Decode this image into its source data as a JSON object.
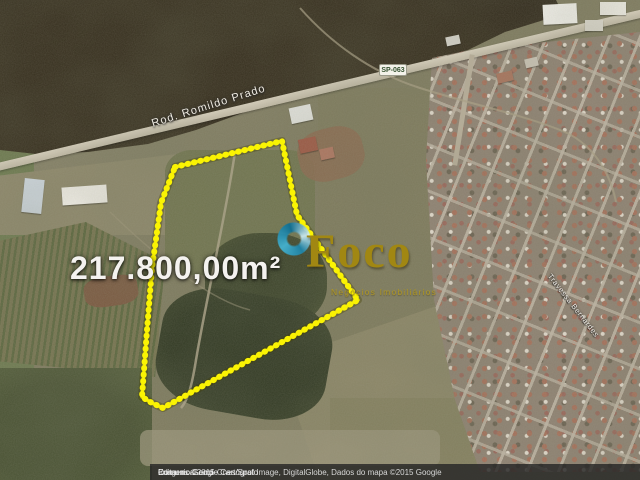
{
  "map": {
    "area_label": "217.800,00m²",
    "road_label": "Rod. Romildo Prado",
    "road_shield": "SP-063",
    "street_label": "Travessa Bernardes",
    "parcel_outline": {
      "color": "#faf303",
      "points": "175,167 282,141 297,215 358,300 163,408 152,403 142,397 147,330 152,268 161,203"
    }
  },
  "logo": {
    "text": "Foco",
    "tagline": "Negócios Imobiliários",
    "color": "#a18712"
  },
  "attribution": {
    "imagery": "Imagens ©2015 Cnes/Spot Image, DigitalGlobe, Dados do mapa ©2015 Google",
    "separator": "-",
    "edit_link": "Editar no Google Cartógrafo",
    "report_link": "Comunicar erro"
  }
}
